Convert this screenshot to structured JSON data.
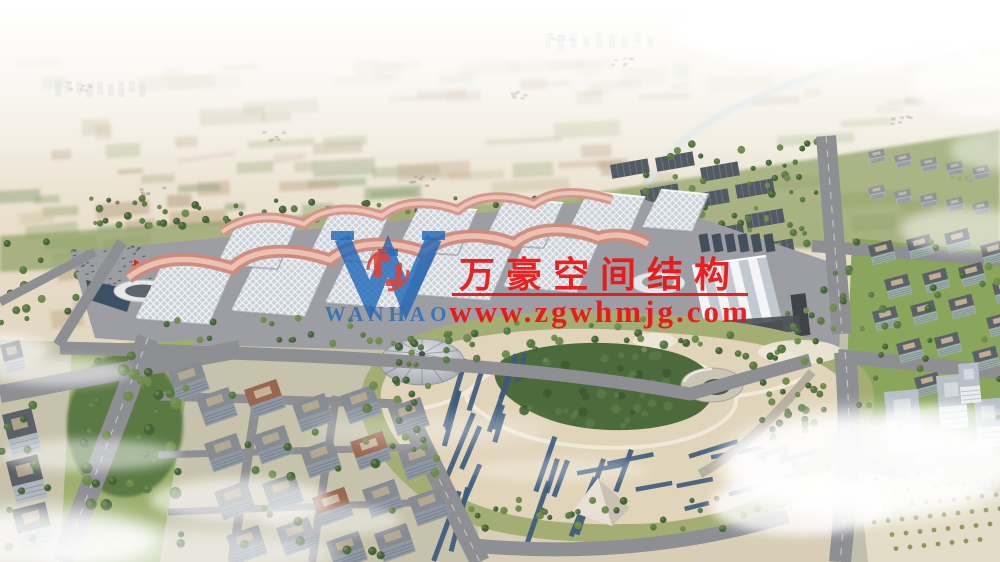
{
  "watermark": {
    "company_name_cn": "万豪空间结构",
    "website_url": "www.zgwhmjg.com",
    "logo_wordmark": "WANHAO",
    "logo_letter": "W",
    "text_color": "#ee1111",
    "logo_blue": "#1b66b8",
    "emblem_red": "#d93a2e"
  },
  "palette": {
    "sky_top": "#f8f5f0",
    "sky_mid": "#f1ebdf",
    "sky_horizon": "#e2d8c4",
    "farmland": [
      "#cdc4a4",
      "#b9b090",
      "#c2a98c",
      "#a9b286",
      "#9fae7e",
      "#b59d82",
      "#8fa57a"
    ],
    "village": "#a8917e",
    "canal": "#d9e1e3",
    "tree_dark": "#46643a",
    "tree_mid": "#587844",
    "tree_light": "#6f8c4e",
    "greenbelt": "#93a369",
    "solar_block": "#525a64",
    "apron": "#9d9ea3",
    "road": "#8e8f93",
    "road_light": "#b4afa0",
    "hall_base": "#ccd2d9",
    "hall_lattice": "#ffffff",
    "ribbon": "#cd897c",
    "ribbon_light": "#eec3b4",
    "park_sand": "#e0d4ba",
    "park_lawn": "#a3ad74",
    "forest": "#4c6b3c",
    "solar_strip": "#3c5a7c",
    "lawn_bright": "#8aa55c",
    "ground_pale": "#c6c2ab",
    "facade": "#aeb5bd",
    "facade_green": "#9db0a9",
    "roof_dark": "#5c6168",
    "roof_terracotta": "#99664f",
    "white_bldg": "#e9ebee",
    "pond": "#3c5166",
    "cloud": "#ffffff"
  }
}
